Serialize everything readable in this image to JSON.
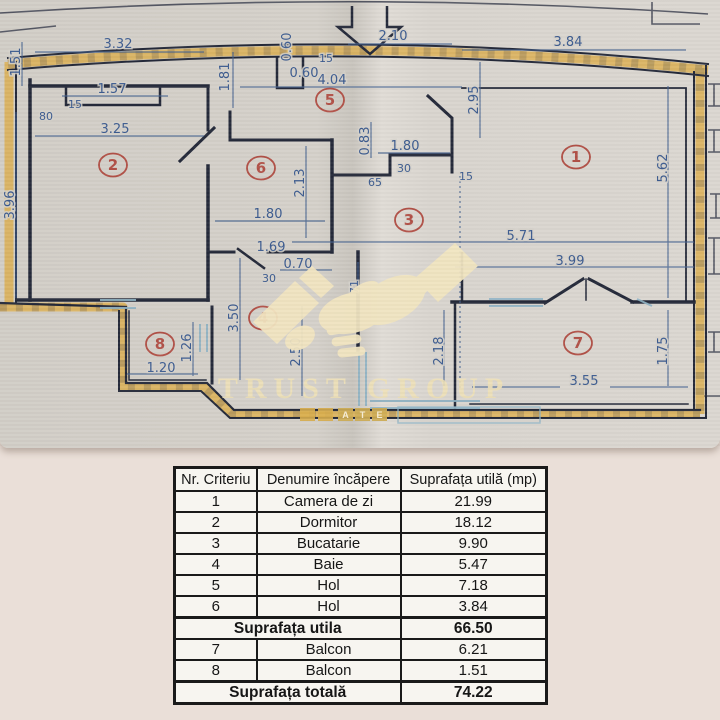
{
  "plan": {
    "watermark": {
      "logo": "handshake-icon",
      "brand": "TRUST GROUP",
      "banner": "ATE"
    },
    "rooms": [
      {
        "n": "1",
        "x": 576,
        "y": 157
      },
      {
        "n": "2",
        "x": 113,
        "y": 165
      },
      {
        "n": "3",
        "x": 409,
        "y": 220
      },
      {
        "n": "4",
        "x": 263,
        "y": 318
      },
      {
        "n": "5",
        "x": 330,
        "y": 100
      },
      {
        "n": "6",
        "x": 261,
        "y": 168
      },
      {
        "n": "7",
        "x": 578,
        "y": 343
      },
      {
        "n": "8",
        "x": 160,
        "y": 344
      }
    ],
    "dimensions": [
      {
        "t": "3.32",
        "x": 118,
        "y": 48
      },
      {
        "t": "1.51",
        "x": 20,
        "y": 62,
        "v": 1
      },
      {
        "t": "1.57",
        "x": 112,
        "y": 93
      },
      {
        "t": "15",
        "x": 75,
        "y": 108,
        "s": 1
      },
      {
        "t": "80",
        "x": 46,
        "y": 120,
        "s": 1
      },
      {
        "t": "3.25",
        "x": 115,
        "y": 133
      },
      {
        "t": "3.96",
        "x": 14,
        "y": 205,
        "v": 1
      },
      {
        "t": "1.81",
        "x": 229,
        "y": 77,
        "v": 1
      },
      {
        "t": "0.60",
        "x": 291,
        "y": 47,
        "v": 1
      },
      {
        "t": "15",
        "x": 326,
        "y": 62,
        "s": 1
      },
      {
        "t": "0.60",
        "x": 304,
        "y": 77
      },
      {
        "t": "4.04",
        "x": 332,
        "y": 84
      },
      {
        "t": "2.10",
        "x": 393,
        "y": 40
      },
      {
        "t": "3.84",
        "x": 568,
        "y": 46
      },
      {
        "t": "2.95",
        "x": 478,
        "y": 100,
        "v": 1
      },
      {
        "t": "5.62",
        "x": 667,
        "y": 168,
        "v": 1
      },
      {
        "t": "0.83",
        "x": 369,
        "y": 141,
        "v": 1
      },
      {
        "t": "1.80",
        "x": 405,
        "y": 150
      },
      {
        "t": "30",
        "x": 404,
        "y": 172,
        "s": 1
      },
      {
        "t": "65",
        "x": 375,
        "y": 186,
        "s": 1
      },
      {
        "t": "15",
        "x": 466,
        "y": 180,
        "s": 1
      },
      {
        "t": "2.13",
        "x": 304,
        "y": 183,
        "v": 1
      },
      {
        "t": "1.80",
        "x": 268,
        "y": 218
      },
      {
        "t": "1.69",
        "x": 271,
        "y": 251
      },
      {
        "t": "0.70",
        "x": 298,
        "y": 268
      },
      {
        "t": "30",
        "x": 269,
        "y": 282,
        "s": 1
      },
      {
        "t": "71",
        "x": 358,
        "y": 287,
        "v": 1,
        "s": 1
      },
      {
        "t": "3.50",
        "x": 238,
        "y": 318,
        "v": 1
      },
      {
        "t": "2.50",
        "x": 300,
        "y": 352,
        "v": 1
      },
      {
        "t": "1.26",
        "x": 191,
        "y": 348,
        "v": 1
      },
      {
        "t": "1.20",
        "x": 161,
        "y": 372
      },
      {
        "t": "5.71",
        "x": 521,
        "y": 240
      },
      {
        "t": "3.99",
        "x": 570,
        "y": 265
      },
      {
        "t": "2.18",
        "x": 443,
        "y": 351,
        "v": 1
      },
      {
        "t": "1.75",
        "x": 667,
        "y": 351,
        "v": 1
      },
      {
        "t": "3.55",
        "x": 584,
        "y": 385
      }
    ],
    "colors": {
      "wall": "#252a3a",
      "gold": "#dcae4c",
      "dimension": "#3d5c90",
      "room_number": "#b15147",
      "window": "#8fb3c4",
      "paper": "#d6d2cb",
      "cream": "#f2e5c1"
    }
  },
  "table": {
    "headers": [
      "Nr. Criteriu",
      "Denumire încăpere",
      "Suprafața utilă (mp)"
    ],
    "rows": [
      {
        "nr": "1",
        "name": "Camera de zi",
        "value": "21.99"
      },
      {
        "nr": "2",
        "name": "Dormitor",
        "value": "18.12"
      },
      {
        "nr": "3",
        "name": "Bucatarie",
        "value": "9.90"
      },
      {
        "nr": "4",
        "name": "Baie",
        "value": "5.47"
      },
      {
        "nr": "5",
        "name": "Hol",
        "value": "7.18"
      },
      {
        "nr": "6",
        "name": "Hol",
        "value": "3.84"
      },
      {
        "label": "Suprafața utila",
        "value": "66.50",
        "summary": true
      },
      {
        "nr": "7",
        "name": "Balcon",
        "value": "6.21"
      },
      {
        "nr": "8",
        "name": "Balcon",
        "value": "1.51"
      },
      {
        "label": "Suprafața totală",
        "value": "74.22",
        "summary": true
      }
    ]
  }
}
